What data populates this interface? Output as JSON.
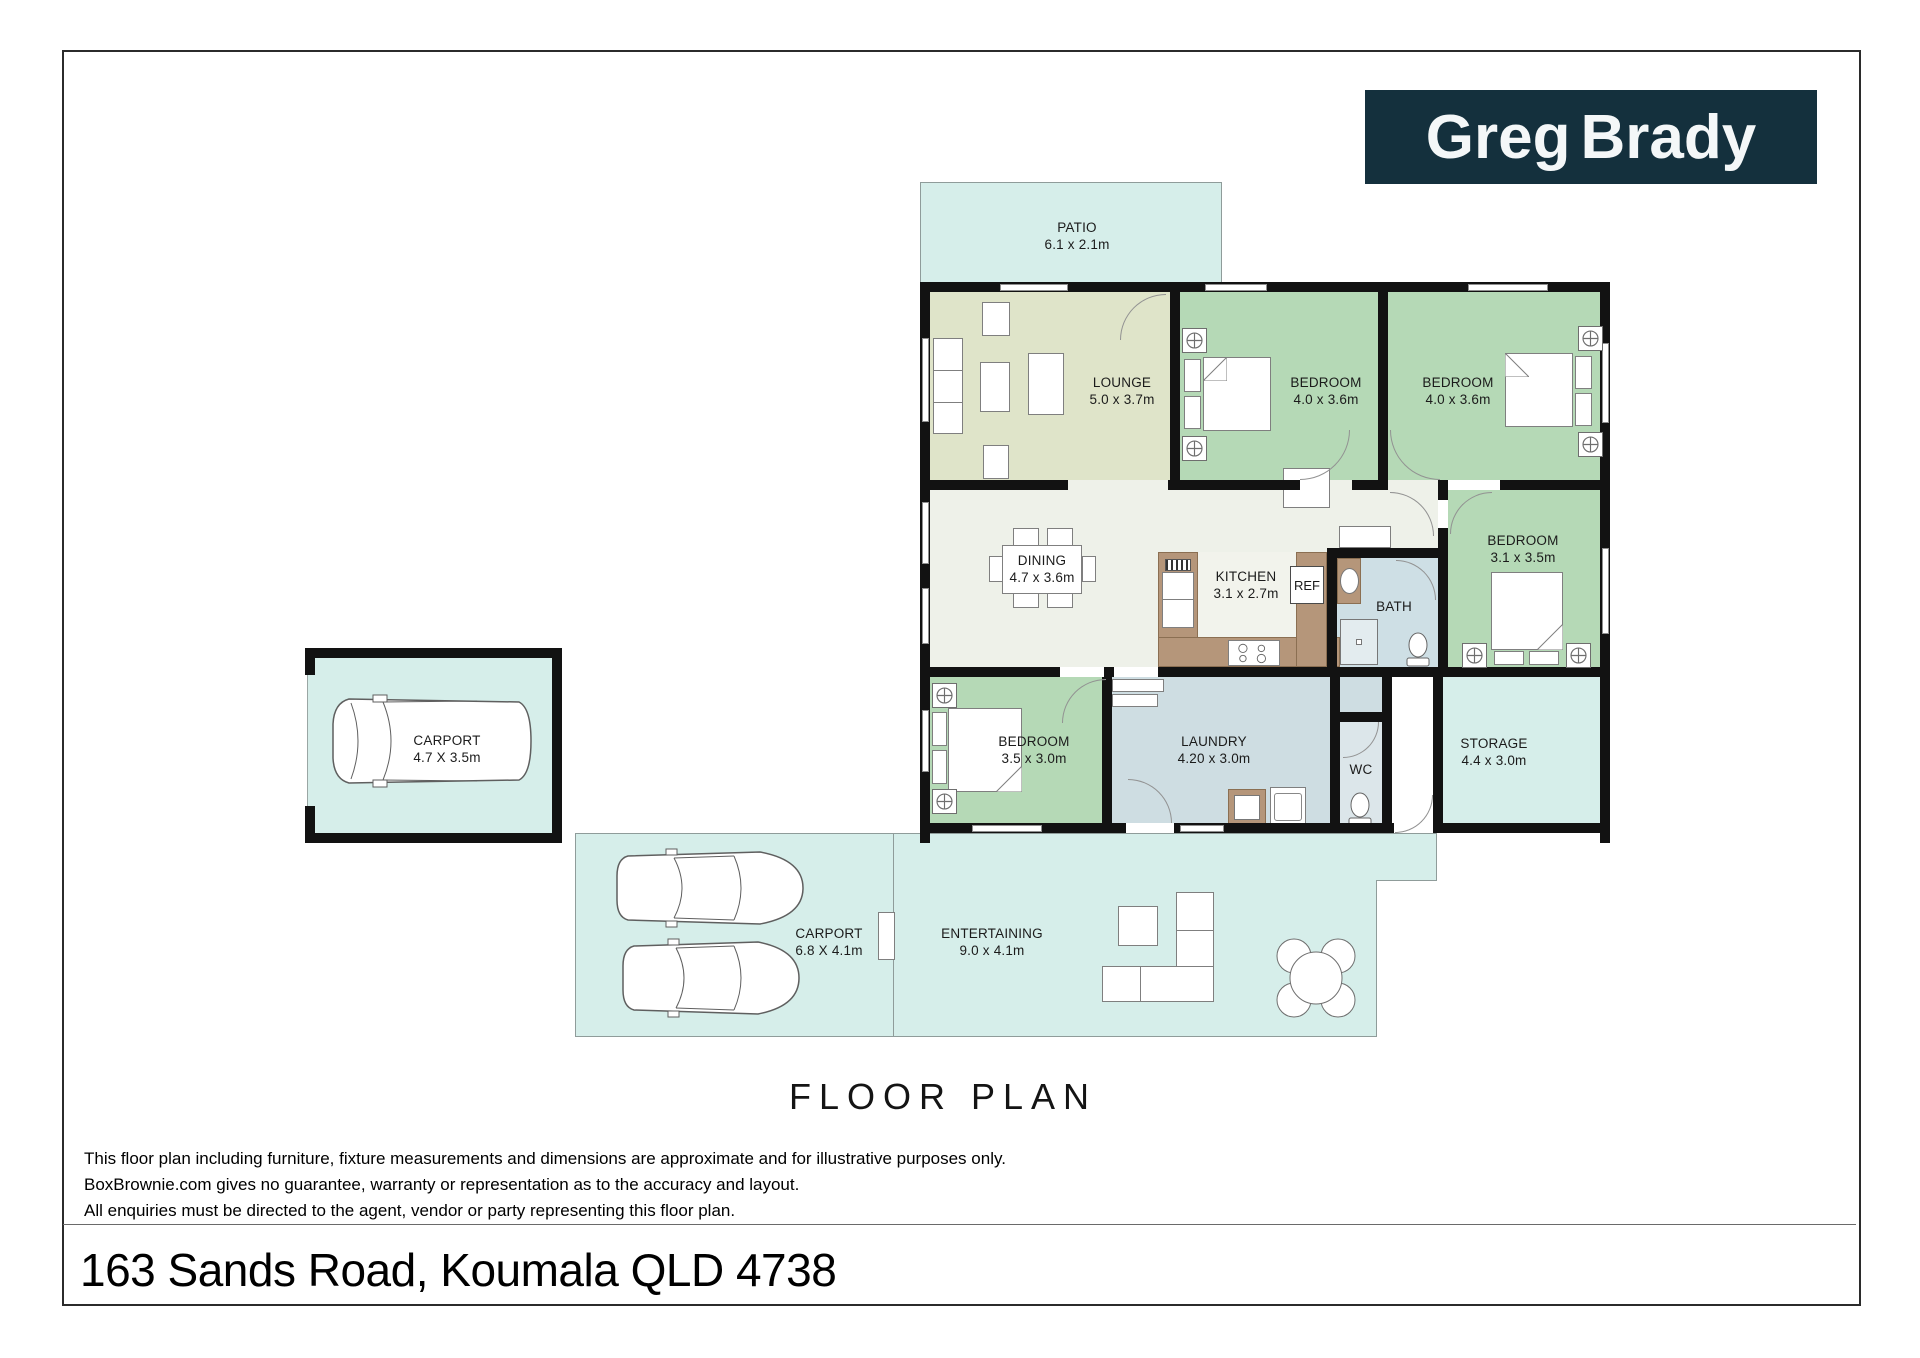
{
  "logo": {
    "part1": "Greg",
    "part2": "Brady"
  },
  "title": "FLOOR PLAN",
  "address": "163 Sands Road, Koumala QLD 4738",
  "disclaimer": [
    "This floor plan including furniture, fixture measurements and dimensions are approximate and for illustrative purposes only.",
    "BoxBrownie.com gives no guarantee, warranty or representation as to the accuracy and layout.",
    "All enquiries must be directed to the agent, vendor or party representing this floor plan."
  ],
  "rooms": {
    "patio": {
      "name": "PATIO",
      "dims": "6.1 x 2.1m"
    },
    "lounge": {
      "name": "LOUNGE",
      "dims": "5.0 x 3.7m"
    },
    "bedroom1": {
      "name": "BEDROOM",
      "dims": "4.0 x 3.6m"
    },
    "bedroom2": {
      "name": "BEDROOM",
      "dims": "4.0 x 3.6m"
    },
    "bedroom3": {
      "name": "BEDROOM",
      "dims": "3.1 x 3.5m"
    },
    "bedroom4": {
      "name": "BEDROOM",
      "dims": "3.5 x 3.0m"
    },
    "dining": {
      "name": "DINING",
      "dims": "4.7 x 3.6m"
    },
    "kitchen": {
      "name": "KITCHEN",
      "dims": "3.1 x 2.7m"
    },
    "ref": {
      "name": "REF"
    },
    "bath": {
      "name": "BATH"
    },
    "laundry": {
      "name": "LAUNDRY",
      "dims": "4.20 x 3.0m"
    },
    "wc": {
      "name": "WC"
    },
    "storage": {
      "name": "STORAGE",
      "dims": "4.4 x 3.0m"
    },
    "carport_single": {
      "name": "CARPORT",
      "dims": "4.7 X 3.5m"
    },
    "carport_double": {
      "name": "CARPORT",
      "dims": "6.8 X 4.1m"
    },
    "entertaining": {
      "name": "ENTERTAINING",
      "dims": "9.0 x 4.1m"
    }
  },
  "colors": {
    "logo_bg": "#14303d",
    "outdoor_area": "#d6eeea",
    "lounge_floor": "#dfe4c9",
    "bedroom_floor": "#b5d9b6",
    "hall_floor": "#eef1e9",
    "bath_floor": "#cedfe5",
    "laundry_floor": "#cedde2",
    "wc_floor": "#dce6ea",
    "counter_brown": "#b5967a",
    "wall": "#121212"
  }
}
